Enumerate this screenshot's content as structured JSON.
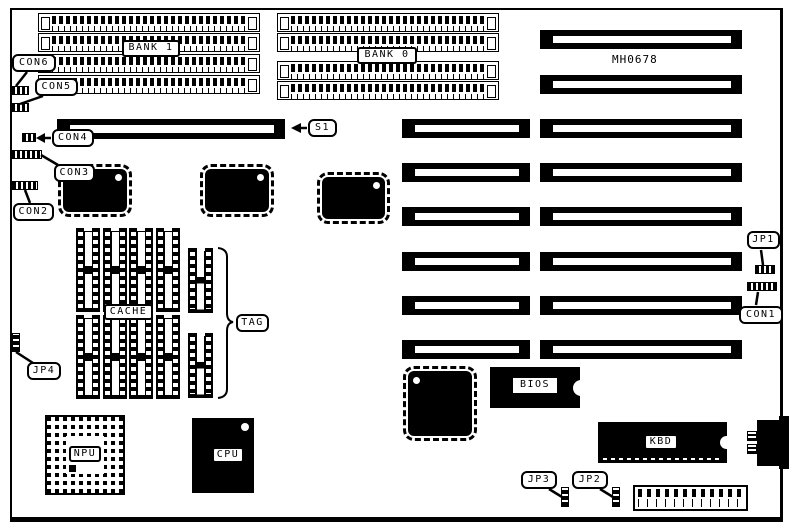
{
  "diagram": {
    "board_code": "MH0678",
    "memory": {
      "bank1": "BANK 1",
      "bank0": "BANK 0"
    },
    "connectors": {
      "con1": "CON1",
      "con2": "CON2",
      "con3": "CON3",
      "con4": "CON4",
      "con5": "CON5",
      "con6": "CON6",
      "s1": "S1"
    },
    "jumpers": {
      "jp1": "JP1",
      "jp2": "JP2",
      "jp3": "JP3",
      "jp4": "JP4"
    },
    "chips": {
      "cache": "CACHE",
      "tag": "TAG",
      "bios": "BIOS",
      "npu": "NPU",
      "cpu": "CPU",
      "kbd": "KBD"
    }
  },
  "colors": {
    "line": "#000000",
    "background": "#ffffff"
  }
}
